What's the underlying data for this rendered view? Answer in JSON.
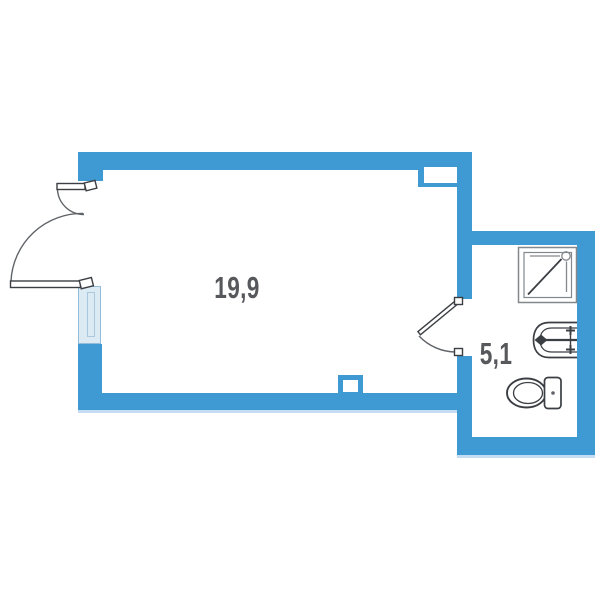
{
  "plan": {
    "title": "studio-apartment-floor-plan",
    "rooms": [
      {
        "name": "main-room",
        "area": "19,9"
      },
      {
        "name": "bathroom",
        "area": "5,1"
      }
    ],
    "fixtures": [
      {
        "name": "shower-tray",
        "icon": "shower-icon"
      },
      {
        "name": "washbasin",
        "icon": "sink-icon"
      },
      {
        "name": "toilet",
        "icon": "toilet-icon"
      }
    ],
    "doors": [
      {
        "name": "entrance-double-door",
        "swing": "outward, two unequal leaves"
      },
      {
        "name": "bathroom-door",
        "swing": "into main room"
      }
    ],
    "windows": [
      {
        "name": "left-wall-window"
      }
    ],
    "features": [
      {
        "name": "vent-niche-top-right"
      },
      {
        "name": "duct-square-bottom-wall"
      }
    ],
    "colors": {
      "wall": "#3F9AD3",
      "wall_shadow": "#C2DCEF",
      "window_fill": "#DCEAF4",
      "window_border": "#92BCDA",
      "window_inner": "#A9C8DE",
      "line_dark": "#3B3F43",
      "line_gray": "#5F6368",
      "fixture_gray": "#83888D",
      "label": "#57585C"
    }
  }
}
